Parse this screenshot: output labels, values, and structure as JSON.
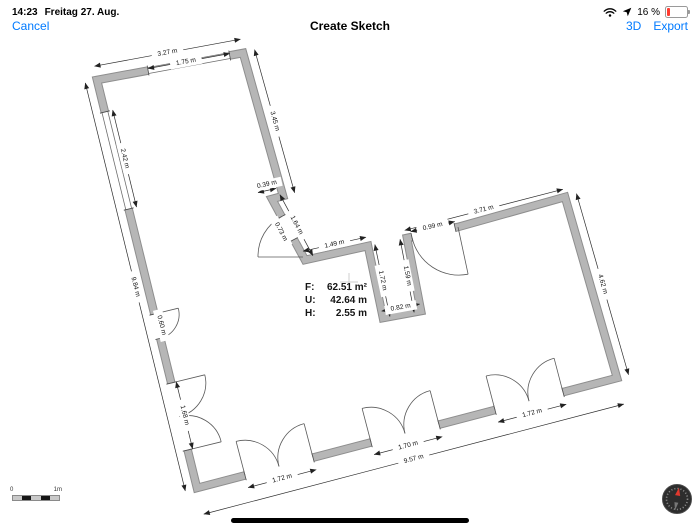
{
  "status_bar": {
    "time": "14:23",
    "date": "Freitag 27. Aug.",
    "battery": "16 %"
  },
  "nav_bar": {
    "cancel_label": "Cancel",
    "title": "Create Sketch",
    "threed_label": "3D",
    "export_label": "Export"
  },
  "floor_plan": {
    "info": {
      "area_label": "F:",
      "area_value": "62.51 m²",
      "perimeter_label": "U:",
      "perimeter_value": "42.64 m",
      "height_label": "H:",
      "height_value": "2.55 m"
    },
    "dimensions": {
      "d327": "3.27 m",
      "d175": "1.75 m",
      "d242": "2.42 m",
      "d984": "9.84 m",
      "d060": "0.60 m",
      "d168": "1.68 m",
      "d345": "3.45 m",
      "d039": "0.39 m",
      "d164": "1.64 m",
      "d073": "0.73 m",
      "d149": "1.49 m",
      "d172_notch": "1.72 m",
      "d159": "1.59 m",
      "d082": "0.82 m",
      "d099": "0.99 m",
      "d371": "3.71 m",
      "d462": "4.62 m",
      "d172_door_left": "1.72 m",
      "d170_door_mid": "1.70 m",
      "d172_door_right": "1.72 m",
      "d957": "9.57 m"
    }
  },
  "scale_bar": {
    "start": "0",
    "end": "1m"
  }
}
